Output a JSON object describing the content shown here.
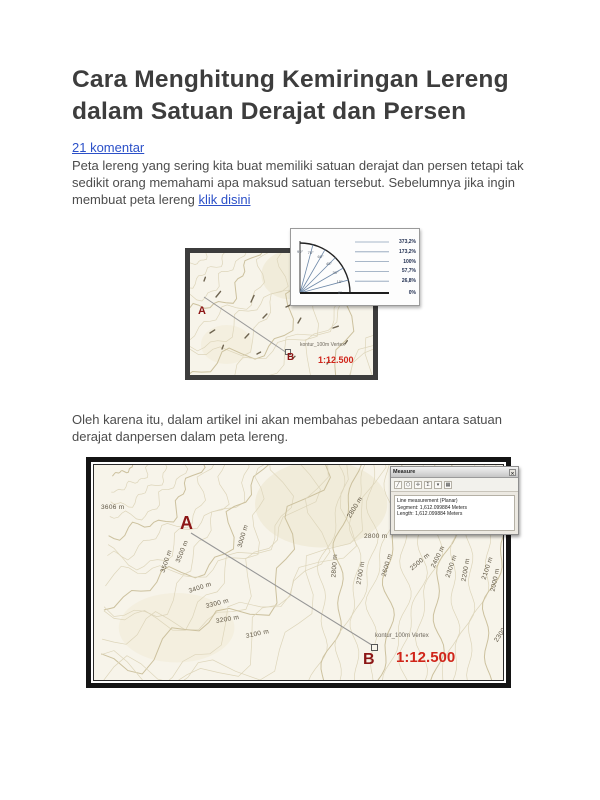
{
  "article": {
    "title": "Cara Menghitung Kemiringan Lereng dalam Satuan Derajat dan Persen",
    "comments_link": "21 komentar",
    "para1_before": "Peta lereng yang sering kita buat memiliki satuan derajat dan persen tetapi tak sedikit orang memahami apa maksud satuan tersebut. Sebelumnya jika ingin membuat peta lereng ",
    "para1_link": "klik disini",
    "para2": "Oleh karena itu, dalam artikel ini akan membahas pebedaan antara satuan derajat danpersen dalam peta lereng."
  },
  "figure1": {
    "point_a": "A",
    "point_b": "B",
    "scale": "1:12.500",
    "vertex_label": "kontur_100m Vertex",
    "protractor": {
      "ray_angles": [
        75,
        60,
        45,
        30,
        15
      ],
      "degree_labels": [
        "90°",
        "75°",
        "60°",
        "45°",
        "30°",
        "15°",
        "0°"
      ],
      "degree_values": [
        90,
        75,
        60,
        45,
        30,
        15,
        0
      ],
      "percent_labels": [
        "373,2%",
        "173,2%",
        "100%",
        "57,7%",
        "26,8%",
        "0%"
      ]
    }
  },
  "figure2": {
    "point_a": "A",
    "point_b": "B",
    "scale": "1:12.500",
    "vertex_label": "kontur_100m Vertex",
    "contour_labels": [
      {
        "text": "3606 m",
        "x": 7,
        "y": 39,
        "r": 0
      },
      {
        "text": "3500 m",
        "x": 69,
        "y": 104,
        "r": -72
      },
      {
        "text": "3500 m",
        "x": 84,
        "y": 94,
        "r": -68
      },
      {
        "text": "3400 m",
        "x": 95,
        "y": 123,
        "r": -18
      },
      {
        "text": "3300 m",
        "x": 112,
        "y": 138,
        "r": -14
      },
      {
        "text": "3200 m",
        "x": 122,
        "y": 153,
        "r": -10
      },
      {
        "text": "3100 m",
        "x": 152,
        "y": 168,
        "r": -12
      },
      {
        "text": "3000 m",
        "x": 146,
        "y": 79,
        "r": -74
      },
      {
        "text": "2800 m",
        "x": 255,
        "y": 49,
        "r": -58
      },
      {
        "text": "2800 m",
        "x": 270,
        "y": 68,
        "r": 0
      },
      {
        "text": "2800 m",
        "x": 240,
        "y": 109,
        "r": -86
      },
      {
        "text": "2700 m",
        "x": 265,
        "y": 116,
        "r": -80
      },
      {
        "text": "2600 m",
        "x": 290,
        "y": 108,
        "r": -74
      },
      {
        "text": "2500 m",
        "x": 317,
        "y": 101,
        "r": -40
      },
      {
        "text": "2400 m",
        "x": 339,
        "y": 99,
        "r": -64
      },
      {
        "text": "2300 m",
        "x": 354,
        "y": 109,
        "r": -72
      },
      {
        "text": "2200 m",
        "x": 370,
        "y": 113,
        "r": -80
      },
      {
        "text": "2100 m",
        "x": 390,
        "y": 111,
        "r": -72
      },
      {
        "text": "2000 m",
        "x": 399,
        "y": 123,
        "r": -78
      },
      {
        "text": "2300 m",
        "x": 402,
        "y": 173,
        "r": -56
      }
    ],
    "measure": {
      "title": "Measure",
      "close_glyph": "✕",
      "toolbar_icons": [
        {
          "name": "line-measure-icon",
          "glyph": "╱"
        },
        {
          "name": "area-measure-icon",
          "glyph": "⬡"
        },
        {
          "name": "feature-measure-icon",
          "glyph": "✛"
        },
        {
          "name": "sum-icon",
          "glyph": "Σ"
        },
        {
          "name": "units-dropdown-icon",
          "glyph": "▾"
        },
        {
          "name": "options-icon",
          "glyph": "▦"
        }
      ],
      "line1": "Line measurement (Planar)",
      "line2": "Segment: 1,612.099884 Meters",
      "line3": "Length: 1,612.099884 Meters"
    }
  },
  "colors": {
    "link_blue": "#2b50c8",
    "marker_red": "#8c1616",
    "scale_red": "#d0251a",
    "map_background": "#f7f4ea",
    "contour_light": "#ddd5ba",
    "contour_dark": "#ccc19e",
    "frame_dark": "#3c3c3c"
  }
}
